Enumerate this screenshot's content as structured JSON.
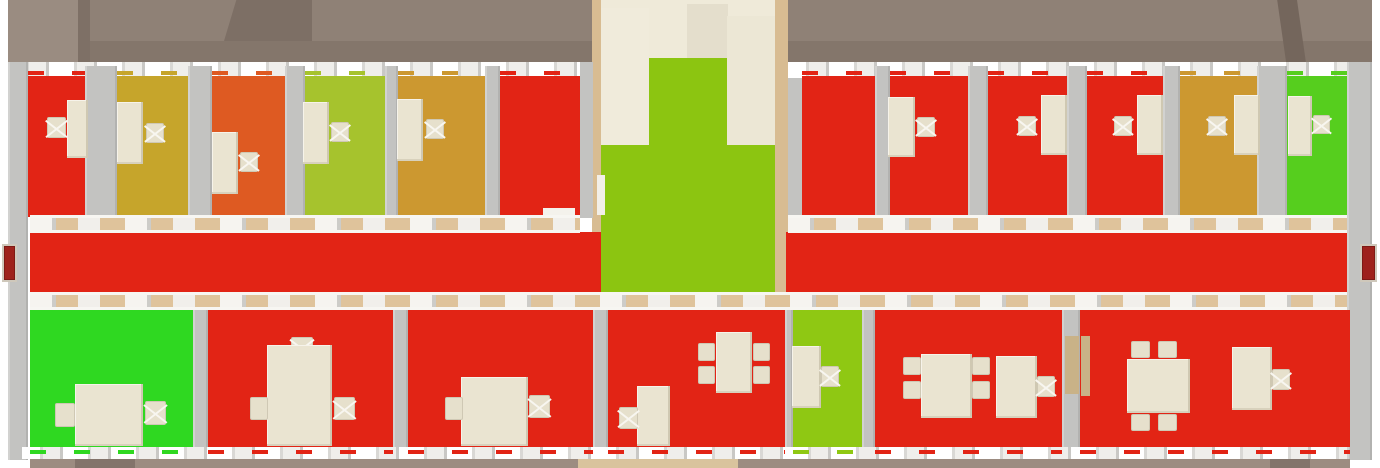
{
  "canvas": {
    "w": 1380,
    "h": 468,
    "bg": "#FFFFFF"
  },
  "palette": {
    "status_red": "#E22415",
    "status_olive": "#C6A52B",
    "status_orange": "#DE5A22",
    "status_yellow_green": "#A6C32D",
    "status_gold": "#CC9830",
    "status_bright_green": "#2FD821",
    "status_green": "#56CE1E",
    "lobby_green": "#8CC511",
    "bottom_yellow_green": "#8FC813",
    "wall_gray": "#C3C3C1",
    "band_tan": "#DFC39B",
    "furniture_beige": "#EAE4D1",
    "roof_taupe": "#8F8176",
    "door_dark_red": "#9E221C",
    "stair_beige": "#F0EBDB"
  },
  "roof": [
    {
      "x": 8,
      "y": 0,
      "w": 1364,
      "h": 41,
      "c": "#8F8176",
      "n": "roof-upper"
    },
    {
      "x": 8,
      "y": 41,
      "w": 1364,
      "h": 22,
      "c": "#84766B",
      "n": "roof-lower"
    },
    {
      "x": 8,
      "y": 0,
      "w": 70,
      "h": 63,
      "c": "#9A8C81",
      "n": "roof-left-corner"
    },
    {
      "x": 78,
      "y": 0,
      "w": 12,
      "h": 63,
      "c": "#7E7066",
      "n": "roof-fold-left"
    },
    {
      "x": 224,
      "y": 0,
      "w": 88,
      "h": 41,
      "c": "#7D6F65",
      "cp": "polygon(14% 0,100% 0,100% 100%,0% 100%)",
      "n": "roof-gable-left"
    },
    {
      "x": 1270,
      "y": 0,
      "w": 36,
      "h": 63,
      "c": "#74665C",
      "cp": "polygon(20% 0,75% 0,100% 100%,45% 100%)",
      "n": "roof-fold-right"
    }
  ],
  "stairwell": [
    {
      "x": 592,
      "y": 0,
      "w": 196,
      "h": 65,
      "c": "#EFEAD9",
      "n": "stair-tower"
    },
    {
      "x": 687,
      "y": 4,
      "w": 41,
      "h": 54,
      "c": "#E4DECC",
      "n": "stair-tower-inner"
    },
    {
      "x": 592,
      "y": 0,
      "w": 9,
      "h": 308,
      "c": "#D8BC92",
      "n": "stair-wall-left-edge"
    },
    {
      "x": 775,
      "y": 0,
      "w": 13,
      "h": 308,
      "c": "#D8BC92",
      "n": "stair-wall-right-edge"
    },
    {
      "x": 601,
      "y": 8,
      "w": 48,
      "h": 146,
      "c": "#F0EBDB",
      "k": "stairs",
      "n": "staircase"
    },
    {
      "x": 727,
      "y": 16,
      "w": 48,
      "h": 130,
      "c": "#ECE7D5",
      "n": "stair-landing"
    },
    {
      "x": 649,
      "y": 58,
      "w": 78,
      "h": 88,
      "c": "#8CC511",
      "n": "lobby-floor-upper"
    },
    {
      "x": 601,
      "y": 145,
      "w": 174,
      "h": 163,
      "c": "#8CC511",
      "n": "lobby-floor"
    },
    {
      "x": 597,
      "y": 175,
      "w": 8,
      "h": 40,
      "c": "#F2EFE8",
      "n": "lobby-door"
    },
    {
      "x": 580,
      "y": 62,
      "w": 13,
      "h": 156,
      "c": "#C3C3C1",
      "n": "stairwell-wall-left"
    },
    {
      "x": 788,
      "y": 62,
      "w": 15,
      "h": 156,
      "c": "#C3C3C1",
      "n": "stairwell-wall-right"
    }
  ],
  "window_bands": {
    "top": [
      {
        "x": 8,
        "y": 62,
        "w": 572,
        "h": 16
      },
      {
        "x": 788,
        "y": 62,
        "w": 559,
        "h": 16
      }
    ],
    "bottom": [
      {
        "x": 22,
        "y": 447,
        "w": 1325,
        "h": 12
      }
    ],
    "top_dash_y": 71,
    "bottom_dash_y": 450,
    "dash_h": 4
  },
  "walls": [
    {
      "x": 8,
      "y": 62,
      "w": 20,
      "h": 398,
      "n": "outer-wall-left"
    },
    {
      "x": 1347,
      "y": 62,
      "w": 25,
      "h": 398,
      "n": "outer-wall-right"
    },
    {
      "x": 85,
      "y": 66,
      "w": 32,
      "h": 150
    },
    {
      "x": 188,
      "y": 66,
      "w": 24,
      "h": 150
    },
    {
      "x": 285,
      "y": 66,
      "w": 20,
      "h": 150
    },
    {
      "x": 385,
      "y": 66,
      "w": 13,
      "h": 150
    },
    {
      "x": 485,
      "y": 66,
      "w": 15,
      "h": 150
    },
    {
      "x": 875,
      "y": 66,
      "w": 15,
      "h": 150
    },
    {
      "x": 968,
      "y": 66,
      "w": 20,
      "h": 150
    },
    {
      "x": 1067,
      "y": 66,
      "w": 20,
      "h": 150
    },
    {
      "x": 1163,
      "y": 66,
      "w": 17,
      "h": 150
    },
    {
      "x": 1257,
      "y": 66,
      "w": 30,
      "h": 150
    },
    {
      "x": 193,
      "y": 308,
      "w": 15,
      "h": 149
    },
    {
      "x": 393,
      "y": 308,
      "w": 15,
      "h": 149
    },
    {
      "x": 593,
      "y": 308,
      "w": 15,
      "h": 149
    },
    {
      "x": 785,
      "y": 308,
      "w": 8,
      "h": 149
    },
    {
      "x": 862,
      "y": 308,
      "w": 13,
      "h": 149
    },
    {
      "x": 1062,
      "y": 308,
      "w": 18,
      "h": 149
    },
    {
      "x": 1065,
      "y": 336,
      "w": 14,
      "h": 58,
      "c": "#C9B287",
      "n": "open-door-leaf"
    }
  ],
  "top_rooms": [
    {
      "id": "t1",
      "c": "#E22415",
      "x": 28,
      "w": 57,
      "f": [
        {
          "t": "desk",
          "x": 67,
          "y": 100,
          "w": 21,
          "h": 58
        },
        {
          "t": "chairX",
          "x": 47,
          "y": 117,
          "w": 19,
          "h": 21
        }
      ]
    },
    {
      "id": "t2",
      "c": "#C6A52B",
      "x": 117,
      "w": 71,
      "f": [
        {
          "t": "desk",
          "x": 117,
          "y": 102,
          "w": 26,
          "h": 62
        },
        {
          "t": "chairX",
          "x": 146,
          "y": 123,
          "w": 18,
          "h": 20
        }
      ]
    },
    {
      "id": "t3",
      "c": "#DE5A22",
      "x": 212,
      "w": 73,
      "f": [
        {
          "t": "desk",
          "x": 212,
          "y": 132,
          "w": 26,
          "h": 62
        },
        {
          "t": "chairX",
          "x": 240,
          "y": 152,
          "w": 18,
          "h": 20
        }
      ]
    },
    {
      "id": "t4",
      "c": "#A6C32D",
      "x": 305,
      "w": 80,
      "f": [
        {
          "t": "desk",
          "x": 303,
          "y": 102,
          "w": 26,
          "h": 62
        },
        {
          "t": "chairX",
          "x": 331,
          "y": 122,
          "w": 18,
          "h": 20
        }
      ]
    },
    {
      "id": "t5",
      "c": "#CC9830",
      "x": 398,
      "w": 87,
      "f": [
        {
          "t": "desk",
          "x": 397,
          "y": 99,
          "w": 26,
          "h": 62
        },
        {
          "t": "chairX",
          "x": 426,
          "y": 119,
          "w": 18,
          "h": 20
        }
      ]
    },
    {
      "id": "t6",
      "c": "#E22415",
      "x": 500,
      "w": 80,
      "f": [
        {
          "t": "sill",
          "x": 543,
          "y": 208,
          "w": 32,
          "h": 8
        }
      ]
    },
    {
      "id": "t7",
      "c": "#E22415",
      "x": 802,
      "w": 73,
      "f": []
    },
    {
      "id": "t8",
      "c": "#E22415",
      "x": 890,
      "w": 78,
      "f": [
        {
          "t": "desk",
          "x": 888,
          "y": 97,
          "w": 27,
          "h": 60
        },
        {
          "t": "chairX",
          "x": 917,
          "y": 117,
          "w": 18,
          "h": 20
        }
      ]
    },
    {
      "id": "t9",
      "c": "#E22415",
      "x": 988,
      "w": 79,
      "f": [
        {
          "t": "chairX",
          "x": 1018,
          "y": 116,
          "w": 18,
          "h": 20
        },
        {
          "t": "desk",
          "x": 1041,
          "y": 95,
          "w": 26,
          "h": 60
        }
      ]
    },
    {
      "id": "t10",
      "c": "#E22415",
      "x": 1087,
      "w": 76,
      "f": [
        {
          "t": "chairX",
          "x": 1114,
          "y": 116,
          "w": 18,
          "h": 20
        },
        {
          "t": "desk",
          "x": 1137,
          "y": 95,
          "w": 26,
          "h": 60
        }
      ]
    },
    {
      "id": "t11",
      "c": "#CC9830",
      "x": 1180,
      "w": 77,
      "f": [
        {
          "t": "chairX",
          "x": 1208,
          "y": 116,
          "w": 18,
          "h": 20
        },
        {
          "t": "desk",
          "x": 1234,
          "y": 95,
          "w": 26,
          "h": 60
        }
      ]
    },
    {
      "id": "t12",
      "c": "#56CE1E",
      "x": 1287,
      "w": 60,
      "f": [
        {
          "t": "desk",
          "x": 1288,
          "y": 96,
          "w": 24,
          "h": 60
        },
        {
          "t": "chairX",
          "x": 1313,
          "y": 115,
          "w": 17,
          "h": 19
        }
      ]
    }
  ],
  "top_floor": {
    "y": 76,
    "h": 141
  },
  "corridor": {
    "floors": [
      {
        "x": 30,
        "y": 232,
        "w": 571,
        "h": 60,
        "c": "#E22415"
      },
      {
        "x": 786,
        "y": 232,
        "w": 561,
        "h": 60,
        "c": "#E22415"
      }
    ],
    "bands": [
      {
        "x": 30,
        "y": 215,
        "w": 550,
        "h": 18
      },
      {
        "x": 788,
        "y": 215,
        "w": 559,
        "h": 18
      },
      {
        "x": 30,
        "y": 292,
        "w": 1317,
        "h": 18
      }
    ],
    "doors": [
      {
        "x": 2,
        "y": 244,
        "w": 15,
        "h": 38,
        "n": "corridor-door-west"
      },
      {
        "x": 1360,
        "y": 244,
        "w": 17,
        "h": 38,
        "n": "corridor-door-east"
      }
    ]
  },
  "bottom_floor": {
    "y": 310,
    "h": 137
  },
  "bottom_rooms": [
    {
      "id": "b1",
      "c": "#2FD821",
      "x": 30,
      "w": 163,
      "f": [
        {
          "t": "table",
          "x": 75,
          "y": 384,
          "w": 68,
          "h": 62
        },
        {
          "t": "chair",
          "x": 55,
          "y": 403,
          "w": 20,
          "h": 24
        },
        {
          "t": "chairX",
          "x": 145,
          "y": 401,
          "w": 21,
          "h": 24
        }
      ]
    },
    {
      "id": "b2",
      "c": "#E22415",
      "x": 208,
      "w": 185,
      "f": [
        {
          "t": "chairX",
          "x": 291,
          "y": 337,
          "w": 22,
          "h": 21
        },
        {
          "t": "table",
          "x": 267,
          "y": 345,
          "w": 65,
          "h": 101
        },
        {
          "t": "chair",
          "x": 250,
          "y": 397,
          "w": 18,
          "h": 23
        },
        {
          "t": "chairX",
          "x": 334,
          "y": 397,
          "w": 21,
          "h": 23
        }
      ]
    },
    {
      "id": "b3",
      "c": "#E22415",
      "x": 408,
      "w": 185,
      "f": [
        {
          "t": "table",
          "x": 461,
          "y": 377,
          "w": 67,
          "h": 69
        },
        {
          "t": "chair",
          "x": 445,
          "y": 397,
          "w": 18,
          "h": 23
        },
        {
          "t": "chairX",
          "x": 529,
          "y": 395,
          "w": 21,
          "h": 23
        }
      ]
    },
    {
      "id": "b4",
      "c": "#E22415",
      "x": 608,
      "w": 177,
      "f": [
        {
          "t": "table",
          "x": 716,
          "y": 332,
          "w": 36,
          "h": 61
        },
        {
          "t": "chair",
          "x": 698,
          "y": 343,
          "w": 17,
          "h": 18
        },
        {
          "t": "chair",
          "x": 698,
          "y": 366,
          "w": 17,
          "h": 18
        },
        {
          "t": "chair",
          "x": 753,
          "y": 343,
          "w": 17,
          "h": 18
        },
        {
          "t": "chair",
          "x": 753,
          "y": 366,
          "w": 17,
          "h": 18
        },
        {
          "t": "desk",
          "x": 637,
          "y": 386,
          "w": 33,
          "h": 60
        },
        {
          "t": "chairX",
          "x": 619,
          "y": 407,
          "w": 19,
          "h": 22
        }
      ]
    },
    {
      "id": "b5",
      "c": "#8FC813",
      "x": 793,
      "w": 69,
      "f": [
        {
          "t": "desk",
          "x": 792,
          "y": 346,
          "w": 29,
          "h": 62
        },
        {
          "t": "chairX",
          "x": 821,
          "y": 366,
          "w": 18,
          "h": 21
        }
      ]
    },
    {
      "id": "b6",
      "c": "#E22415",
      "x": 875,
      "w": 187,
      "f": [
        {
          "t": "chair",
          "x": 903,
          "y": 357,
          "w": 18,
          "h": 18
        },
        {
          "t": "chair",
          "x": 903,
          "y": 381,
          "w": 18,
          "h": 18
        },
        {
          "t": "table",
          "x": 921,
          "y": 354,
          "w": 51,
          "h": 64
        },
        {
          "t": "chair",
          "x": 972,
          "y": 357,
          "w": 18,
          "h": 18
        },
        {
          "t": "chair",
          "x": 972,
          "y": 381,
          "w": 18,
          "h": 18
        },
        {
          "t": "desk",
          "x": 996,
          "y": 356,
          "w": 41,
          "h": 62
        },
        {
          "t": "chairX",
          "x": 1037,
          "y": 376,
          "w": 18,
          "h": 21
        }
      ]
    },
    {
      "id": "b7",
      "c": "#E22415",
      "x": 1080,
      "w": 270,
      "f": [
        {
          "t": "door",
          "x": 1081,
          "y": 336,
          "w": 9,
          "h": 60
        },
        {
          "t": "chair",
          "x": 1131,
          "y": 341,
          "w": 19,
          "h": 17
        },
        {
          "t": "chair",
          "x": 1158,
          "y": 341,
          "w": 19,
          "h": 17
        },
        {
          "t": "table",
          "x": 1127,
          "y": 359,
          "w": 63,
          "h": 54
        },
        {
          "t": "chair",
          "x": 1131,
          "y": 414,
          "w": 19,
          "h": 17
        },
        {
          "t": "chair",
          "x": 1158,
          "y": 414,
          "w": 19,
          "h": 17
        },
        {
          "t": "desk",
          "x": 1232,
          "y": 347,
          "w": 40,
          "h": 63
        },
        {
          "t": "chairX",
          "x": 1272,
          "y": 369,
          "w": 18,
          "h": 21
        }
      ]
    }
  ],
  "ground": [
    {
      "x": 30,
      "y": 459,
      "w": 45,
      "h": 9,
      "c": "#9C8C81"
    },
    {
      "x": 75,
      "y": 459,
      "w": 60,
      "h": 9,
      "c": "#83746B"
    },
    {
      "x": 135,
      "y": 459,
      "w": 443,
      "h": 9,
      "c": "#9C8C81"
    },
    {
      "x": 578,
      "y": 459,
      "w": 160,
      "h": 9,
      "c": "#D9C39D"
    },
    {
      "x": 738,
      "y": 459,
      "w": 532,
      "h": 9,
      "c": "#9C8C81"
    },
    {
      "x": 1270,
      "y": 459,
      "w": 40,
      "h": 9,
      "c": "#83746B"
    },
    {
      "x": 1310,
      "y": 459,
      "w": 40,
      "h": 9,
      "c": "#9C8C81"
    }
  ]
}
